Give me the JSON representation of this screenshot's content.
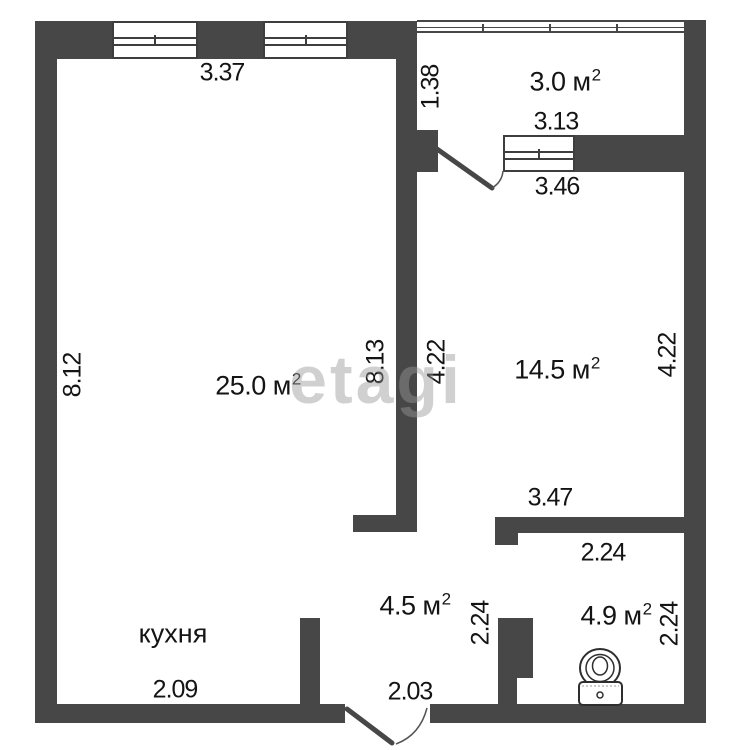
{
  "watermark": {
    "text": "etagi"
  },
  "rooms": {
    "balcony": {
      "area": "3.0",
      "unit": "м",
      "sup": "2"
    },
    "living": {
      "area": "25.0",
      "unit": "м",
      "sup": "2"
    },
    "bedroom": {
      "area": "14.5",
      "unit": "м",
      "sup": "2"
    },
    "hall": {
      "area": "4.5",
      "unit": "м",
      "sup": "2"
    },
    "bathroom": {
      "area": "4.9",
      "unit": "м",
      "sup": "2"
    },
    "kitchen": {
      "label": "кухня"
    }
  },
  "dims": {
    "living_top": "3.37",
    "balcony_depth": "1.38",
    "balcony_width": "3.13",
    "bedroom_top": "3.46",
    "living_left": "8.12",
    "living_right": "8.13",
    "bedroom_left": "4.22",
    "bedroom_right": "4.22",
    "bedroom_bottom": "3.47",
    "bath_top": "2.24",
    "hall_right": "2.24",
    "bath_right": "2.24",
    "kitchen_bottom": "2.09",
    "entry_bottom": "2.03"
  },
  "colors": {
    "wall": "#474747",
    "text": "#141414",
    "watermark": "#969696",
    "background": "#ffffff"
  }
}
